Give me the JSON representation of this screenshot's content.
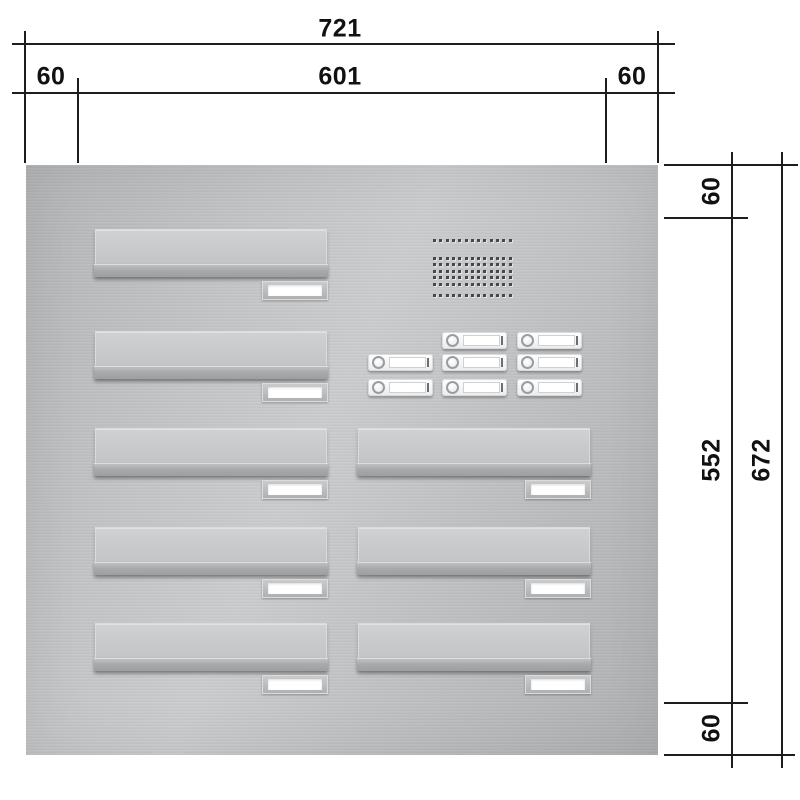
{
  "title": "Letterbox panel technical drawing",
  "dimensions": {
    "top_total": "721",
    "top_left_margin": "60",
    "top_center": "601",
    "top_right_margin": "60",
    "right_top_margin": "60",
    "right_center": "552",
    "right_total": "672",
    "right_bottom_margin": "60"
  },
  "panel": {
    "material_color": "#bfc1c3",
    "mailbox_units": [
      {
        "column": "left",
        "row": 1
      },
      {
        "column": "left",
        "row": 2
      },
      {
        "column": "left",
        "row": 3
      },
      {
        "column": "left",
        "row": 4
      },
      {
        "column": "left",
        "row": 5
      },
      {
        "column": "right",
        "row": 3
      },
      {
        "column": "right",
        "row": 4
      },
      {
        "column": "right",
        "row": 5
      }
    ],
    "bell_buttons": {
      "count": 8,
      "grid": [
        [
          0,
          1,
          1
        ],
        [
          1,
          1,
          1
        ],
        [
          1,
          1,
          1
        ]
      ]
    },
    "speaker_grille": {
      "columns": 13,
      "rows": 7,
      "row_pattern": "1-5-1"
    }
  }
}
